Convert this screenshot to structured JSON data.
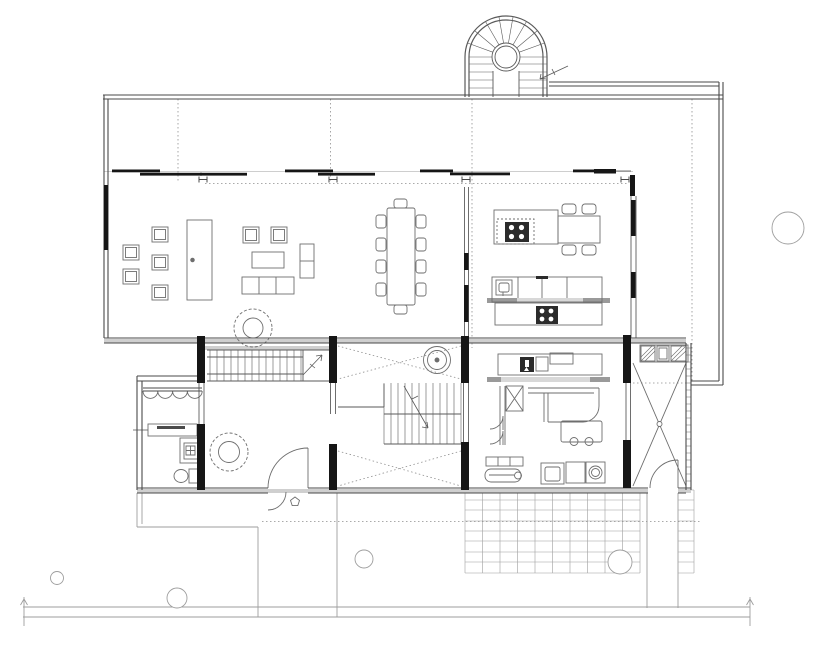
{
  "canvas": {
    "width": 825,
    "height": 648,
    "background": "#ffffff"
  },
  "colors": {
    "wall": "#4a4a4a",
    "pier": "#161616",
    "furniture": "#6e6e6e",
    "stair": "#5a5a5a",
    "site": "#9e9e9e",
    "dotted": "#8f8f8f",
    "band": "#cfcfcf",
    "band_dark": "#9a9a9a",
    "fixture_dark": "#2b2b2b",
    "paper": "#ffffff"
  },
  "drawing": {
    "kind": "architectural-floor-plan",
    "text_labels": [],
    "rooms": [
      "living-area",
      "dining-area",
      "kitchen",
      "pantry-laundry",
      "entry-hall",
      "bathroom",
      "stair-hall",
      "storage-room"
    ],
    "fixtures": [
      "spiral-stair",
      "straight-stair-upper",
      "straight-stair-main",
      "kitchen-island-cooktop",
      "kitchen-counter-sink",
      "dining-table-10-chairs",
      "sofa-set",
      "armchair-group",
      "wood-stove",
      "coat-hooks",
      "toilet",
      "shower",
      "wash-basin",
      "washing-machine",
      "utility-cart",
      "chaise"
    ],
    "site_elements": [
      "street-edge-lines",
      "survey-ticks",
      "paved-patio-grid",
      "garden-path",
      "trees",
      "terrace-step",
      "column-grid-dotted-lines",
      "void-cross-markers"
    ]
  }
}
